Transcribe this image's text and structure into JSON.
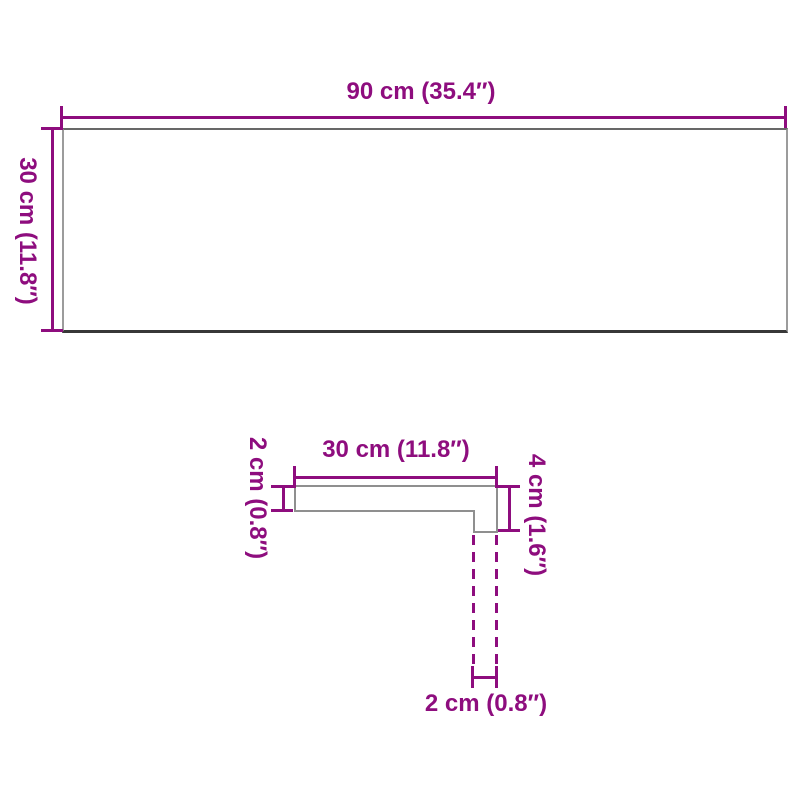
{
  "colors": {
    "dimension_accent": "#8e0d7e",
    "shape_outline": "#8f8f8f",
    "shape_outline_dark": "#383838",
    "background": "#ffffff"
  },
  "top_view": {
    "width_label": "90 cm (35.4″)",
    "height_label": "30 cm (11.8″)"
  },
  "profile_view": {
    "width_label": "30 cm (11.8″)",
    "thickness_label": "2 cm (0.8″)",
    "height_label": "4 cm (1.6″)",
    "leg_width_label": "2 cm (0.8″)"
  }
}
